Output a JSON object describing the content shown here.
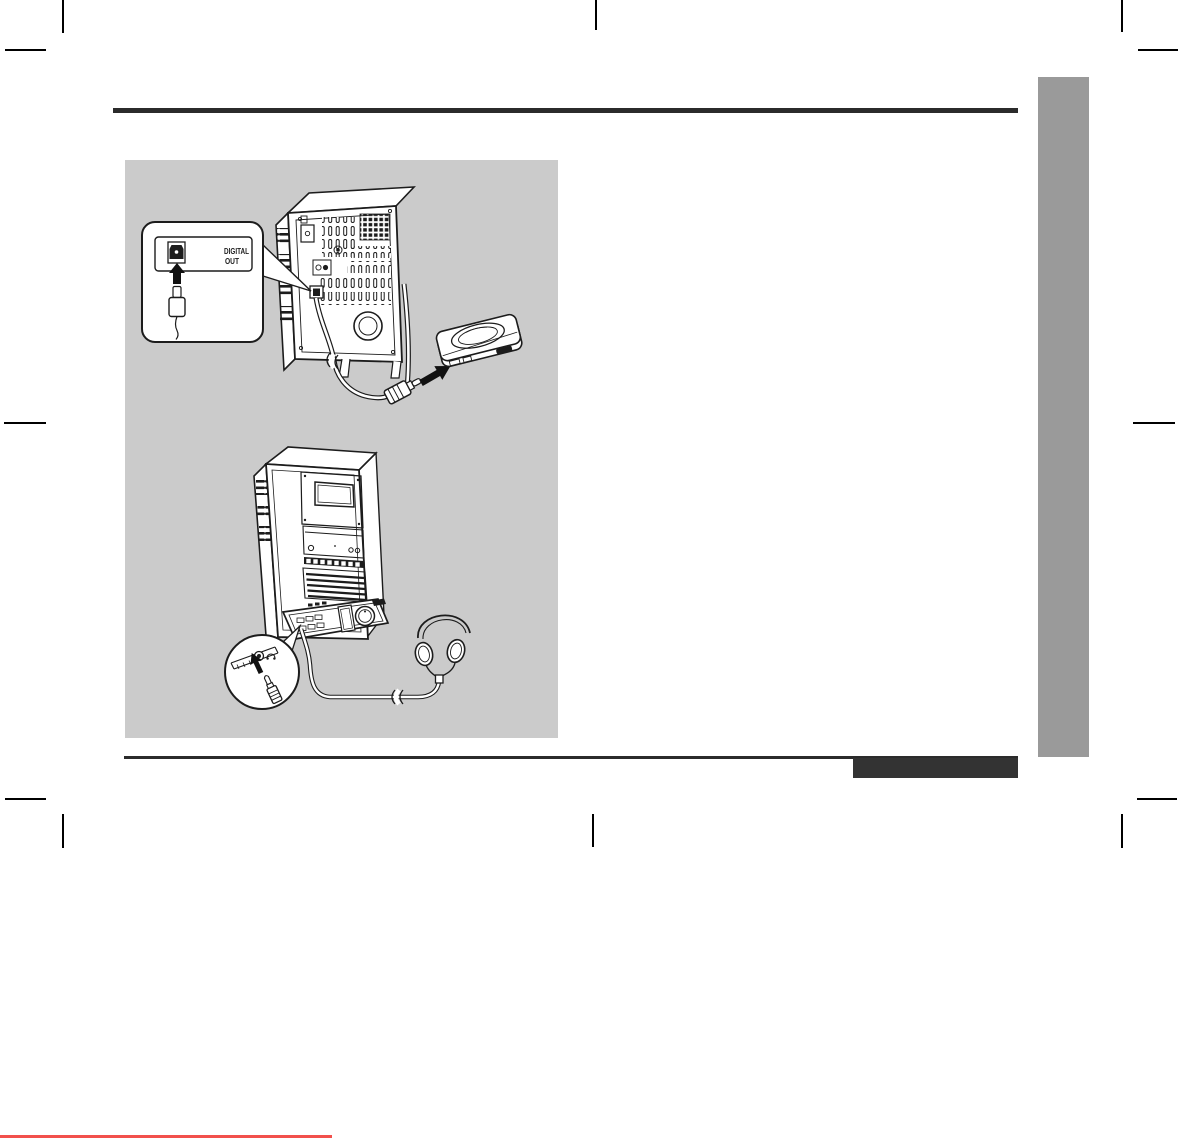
{
  "page": {
    "width": 1179,
    "height": 1143,
    "background": "#ffffff"
  },
  "colors": {
    "illustration_panel_bg": "#cbcbcb",
    "sidebar_bar": "#9a9a9a",
    "horizontal_rules": "#2b2b2b",
    "footer_black_box": "#333333",
    "bottom_red_line": "#f2504c",
    "line_art_ink": "#1c1c1c",
    "crop_marks": "#000000"
  },
  "illustration": {
    "digital_out_callout": {
      "line1": "DIGITAL",
      "line2": "OUT"
    },
    "icons": [
      "optical-out-port-icon",
      "up-arrow-icon",
      "optical-plug-icon",
      "stereo-rear-view",
      "optical-cable",
      "cable-break-mark",
      "power-cord",
      "right-arrow-icon",
      "md-recorder",
      "stereo-front-view",
      "headphone-jack-icon",
      "headphone-plug-icon",
      "headphones-icon"
    ]
  }
}
